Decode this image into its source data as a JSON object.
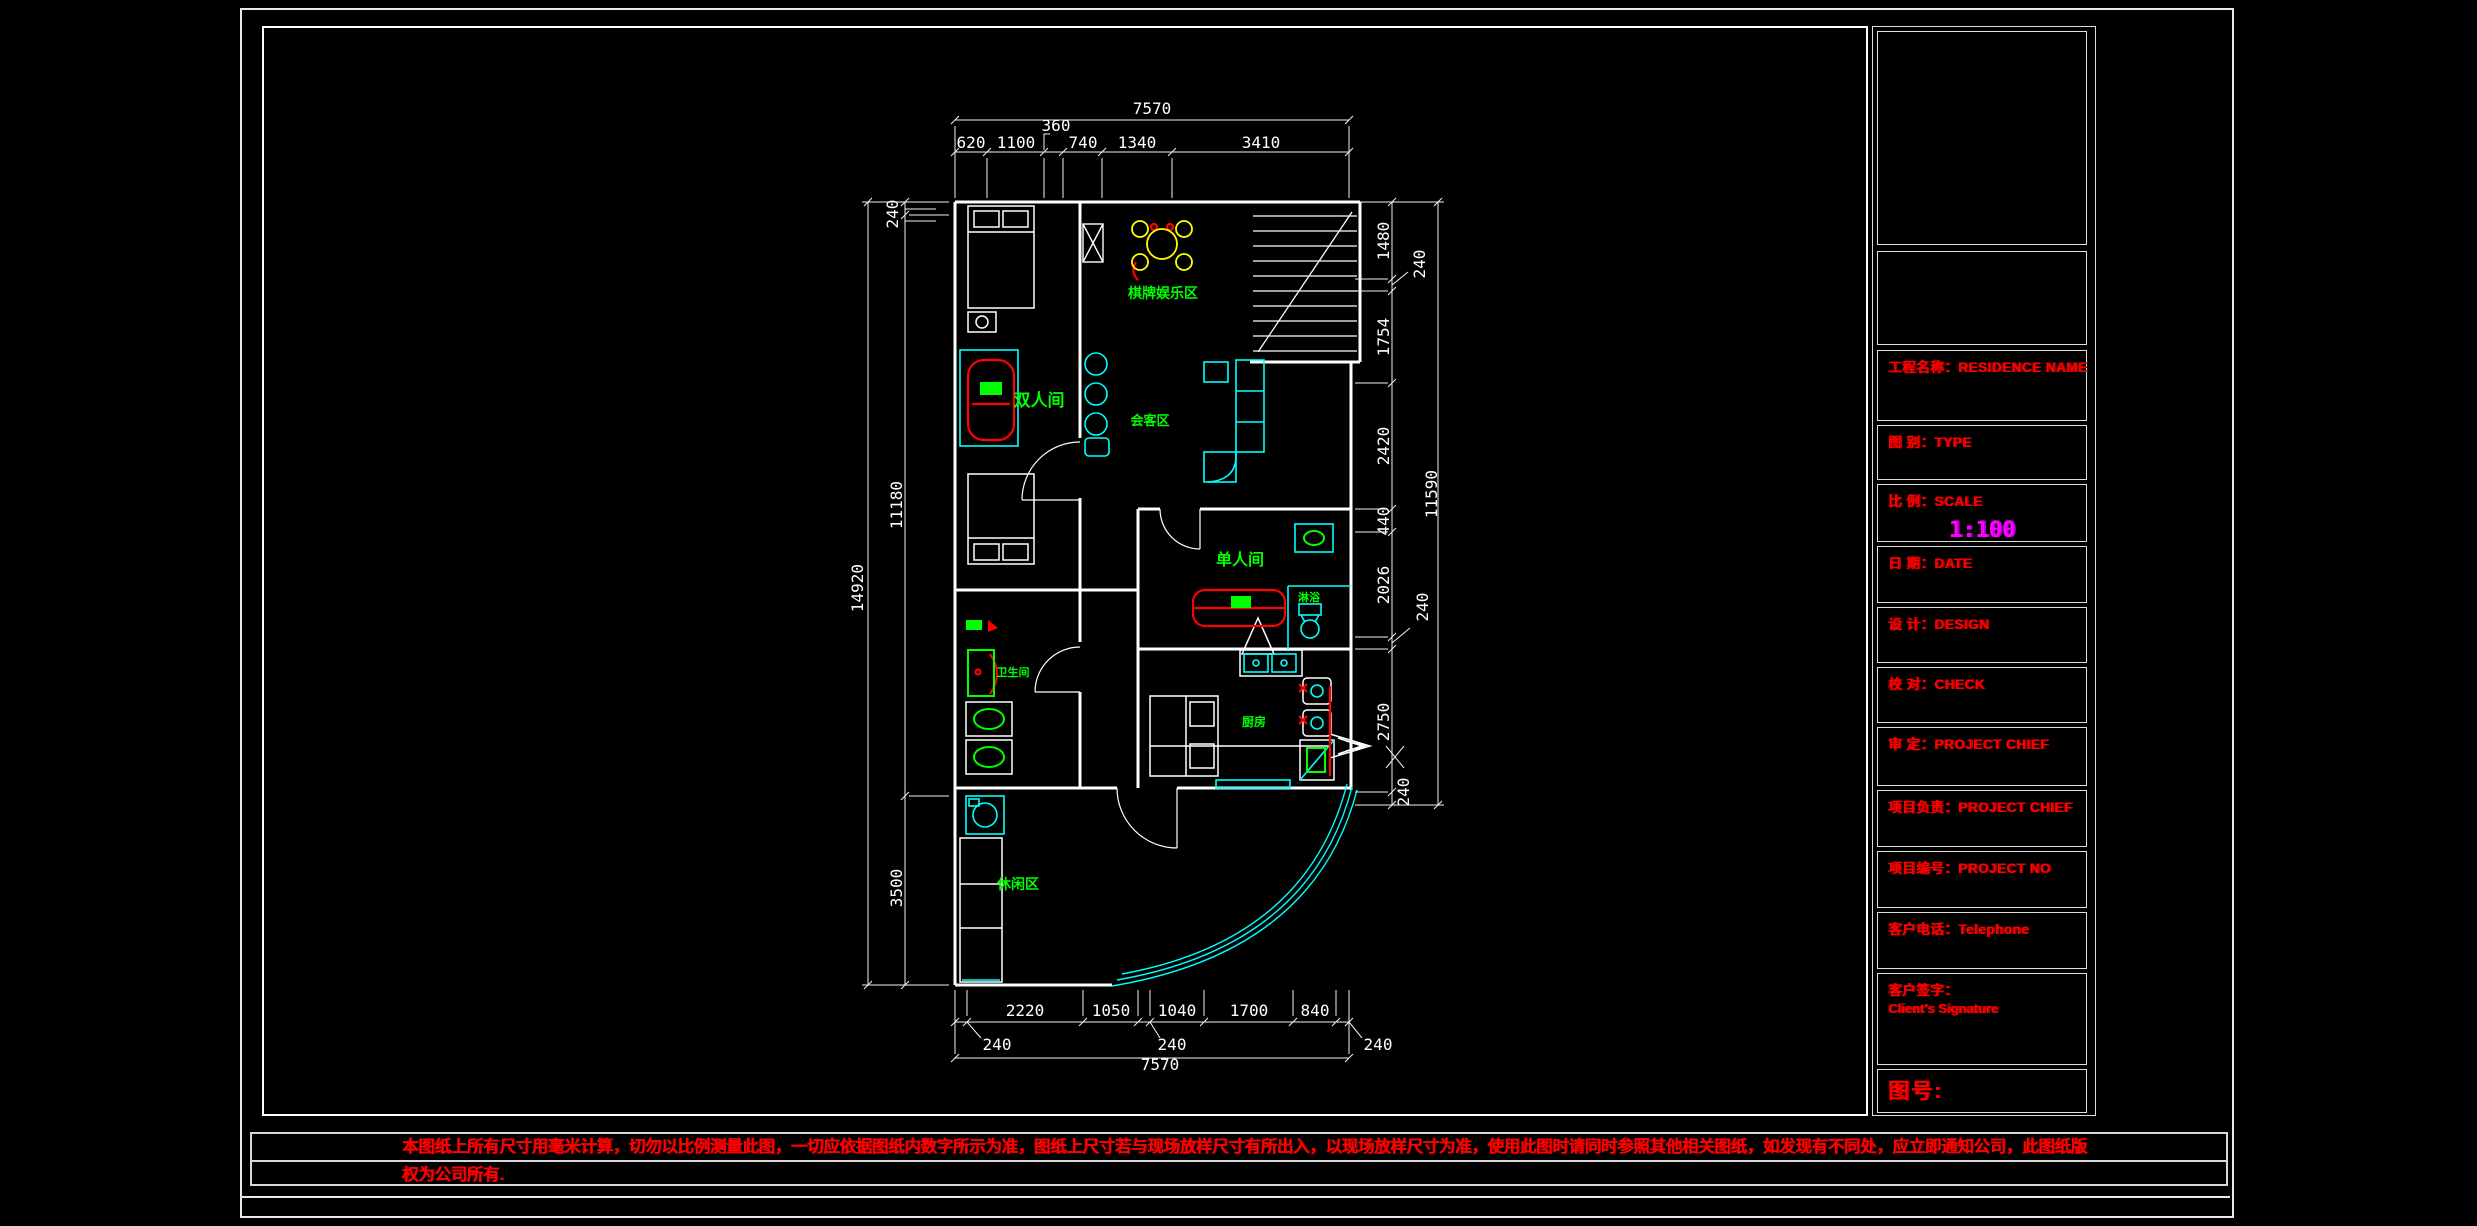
{
  "drawing": {
    "title_block": {
      "project_name": "工程名称：RESIDENCE NAME",
      "type": "图 别：TYPE",
      "scale_label": "比 例：SCALE",
      "scale_value": "1:100",
      "date": "日 期：DATE",
      "design": "设 计：DESIGN",
      "check": "校 对：CHECK",
      "approve": "审 定：PROJECT CHIEF",
      "chief": "项目负责：PROJECT CHIEF",
      "project_no": "项目编号：PROJECT NO",
      "telephone": "客户电话：Telephone",
      "signature_cn": "客户签字：",
      "signature_en": "Client's Signature",
      "drawing_no": "图号:"
    },
    "disclaimer_line1": "本图纸上所有尺寸用毫米计算，切勿以比例测量此图，一切应依据图纸内数字所示为准，图纸上尺寸若与现场放样尺寸有所出入，以现场放样尺寸为准，使用此图时请同时参照其他相关图纸，如发现有不同处，应立即通知公司，此图纸版",
    "disclaimer_line2": "权为公司所有.",
    "labels": {
      "games_area": "棋牌娱乐区",
      "double_room": "双人间",
      "reception": "会客区",
      "single_room": "单人间",
      "shower": "淋浴",
      "bathroom": "卫生间",
      "kitchen": "厨房",
      "lounge": "休闲区"
    },
    "dims": {
      "top_total": "7570",
      "top": [
        "620",
        "1100",
        "360",
        "740",
        "1340",
        "3410"
      ],
      "bottom": [
        "240",
        "2220",
        "1050",
        "240",
        "1040",
        "1700",
        "840",
        "240"
      ],
      "bottom_total": "7570",
      "left": [
        "240",
        "11180",
        "3500"
      ],
      "left_total": "14920",
      "right": [
        "1480",
        "240",
        "1754",
        "2420",
        "440",
        "2026",
        "240",
        "2750",
        "240"
      ],
      "right_total": "11590"
    },
    "colors": {
      "wall": "#ffffff",
      "furniture": "#00ffff",
      "fixture_red": "#ff0000",
      "label_green": "#00ff00",
      "dining_yellow": "#ffff00",
      "title_red": "#ff0000",
      "scale_magenta": "#ff00ff"
    }
  }
}
